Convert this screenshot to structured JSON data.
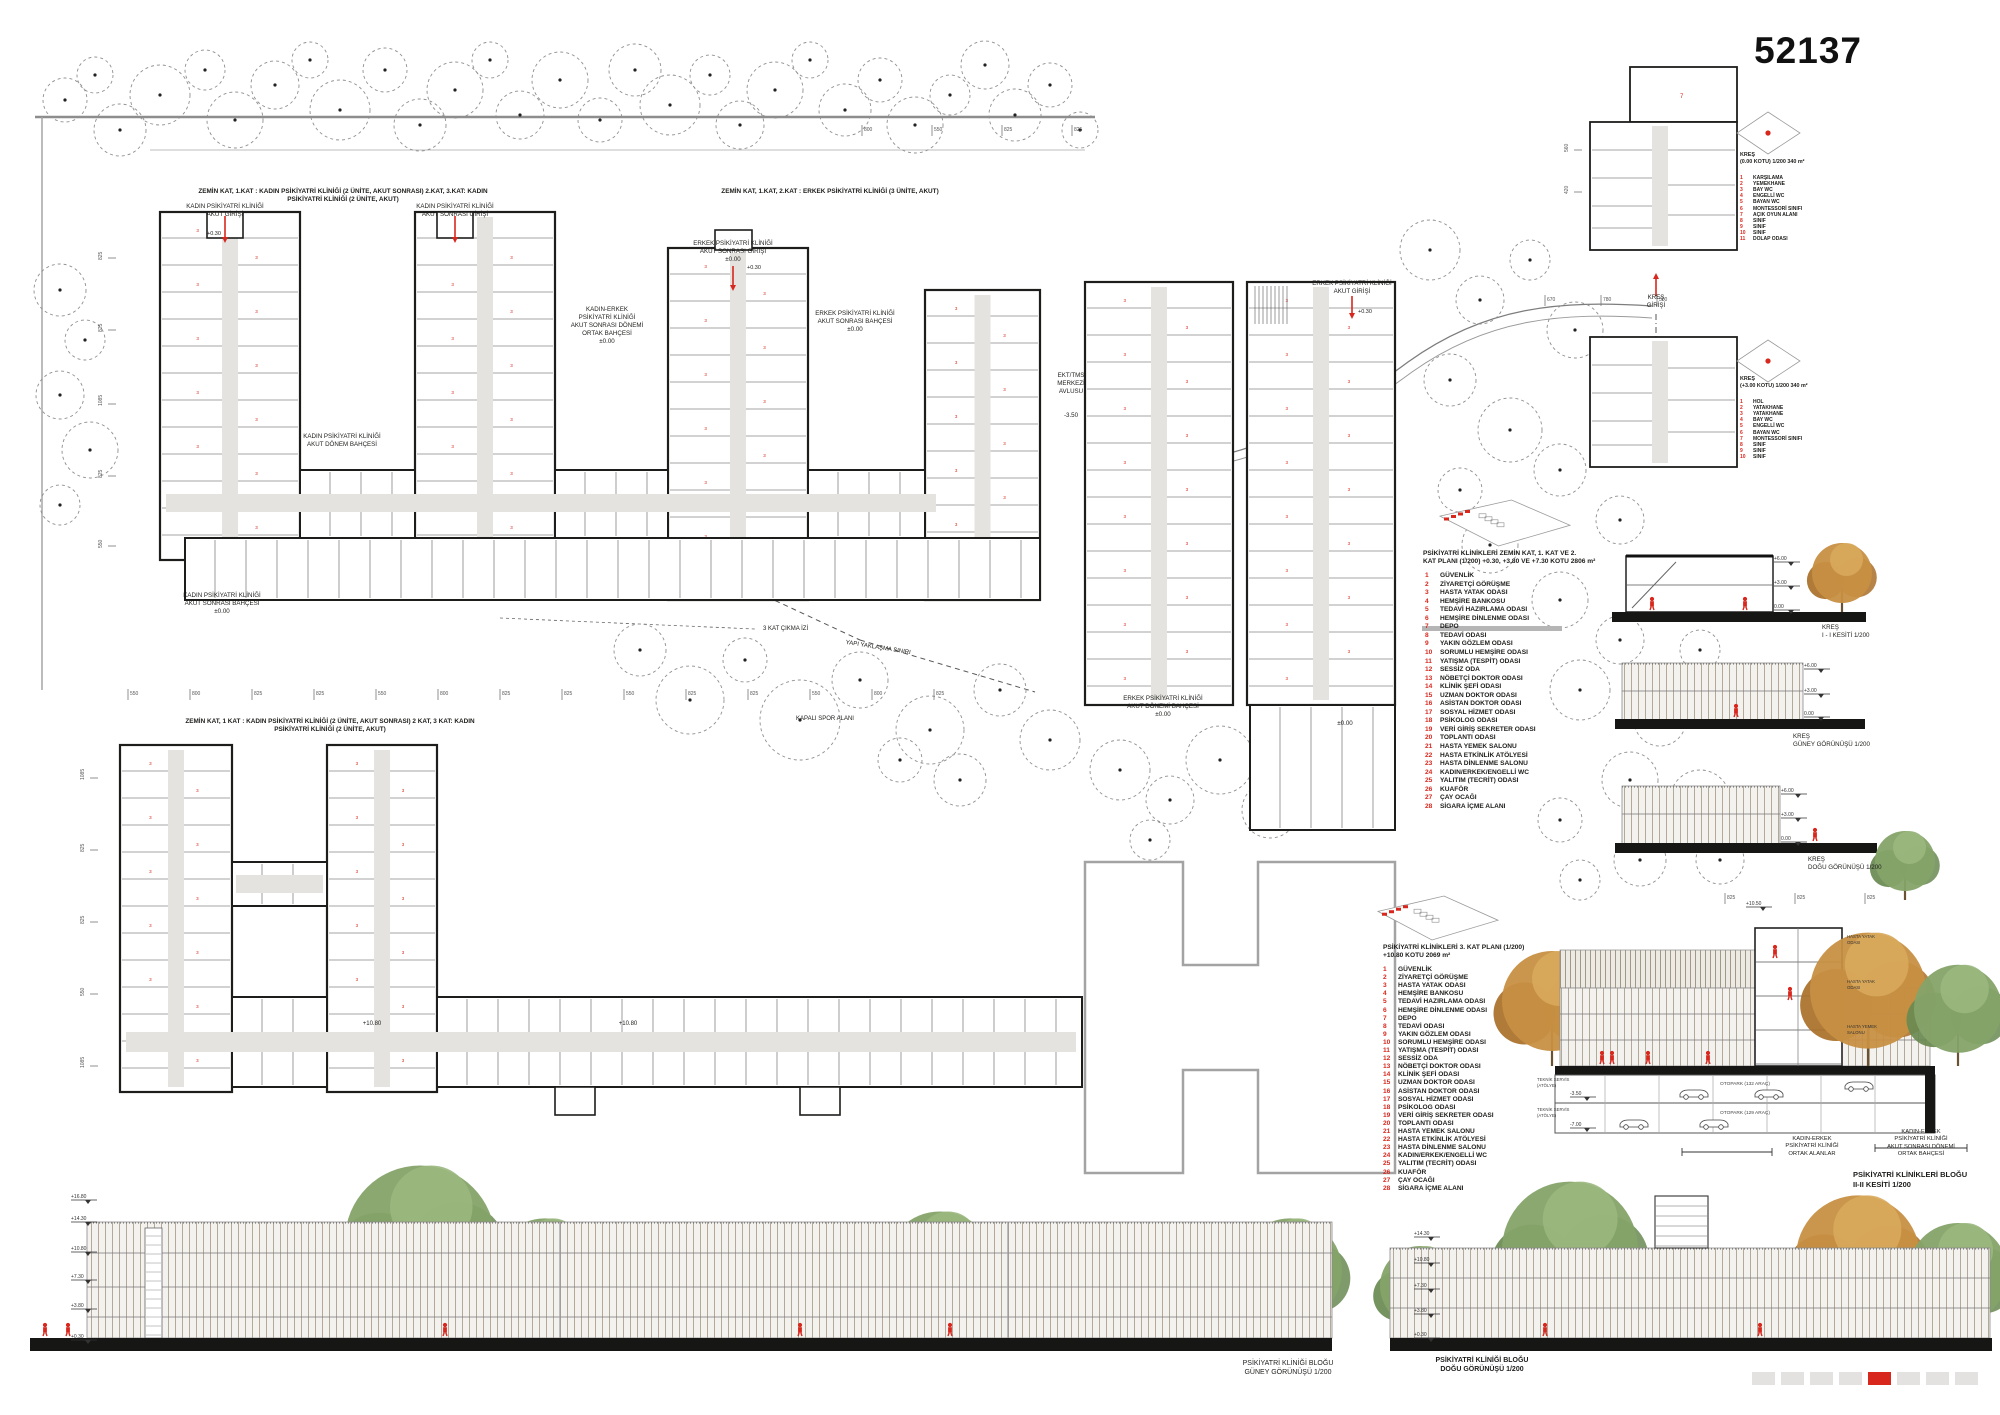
{
  "board": {
    "number": "52137"
  },
  "colors": {
    "accent": "#d8271d",
    "wall": "#1d1d1b",
    "corridor": "#e4e3e0",
    "gray_outline": "#a3a3a3",
    "ground": "#161614",
    "dim": "#555555",
    "tree_dash": "#8f8f8f",
    "green": "#85a369",
    "green_dark": "#698a51",
    "autumn": "#c78f42",
    "autumn_dark": "#a96f28",
    "facade": "#f4f2ee",
    "mullion": "#b2a998",
    "page_square": "#e3e2e0"
  },
  "annotations": [
    {
      "t": "ZEMİN KAT, 1.KAT : KADIN PSİKİYATRİ KLİNİĞİ (2 ÜNİTE, AKUT SONRASI) 2.KAT, 3.KAT: KADIN PSİKİYATRİ KLİNİĞİ (2 ÜNİTE, AKUT)",
      "x": 343,
      "y": 188,
      "size": 6.4,
      "bold": true
    },
    {
      "t": "ZEMİN KAT, 1.KAT, 2.KAT : ERKEK PSİKİYATRİ KLİNİĞİ (3 ÜNİTE, AKUT)",
      "x": 830,
      "y": 188,
      "size": 6.4,
      "bold": true
    },
    {
      "t": "ZEMİN KAT, 1 KAT : KADIN PSİKİYATRİ KLİNİĞİ (2 ÜNİTE, AKUT SONRASI) 2 KAT, 3 KAT: KADIN PSİKİYATRİ KLİNİĞİ (2 ÜNİTE, AKUT)",
      "x": 330,
      "y": 718,
      "size": 6.4,
      "bold": true
    },
    {
      "t": "KADIN PSİKİYATRİ KLİNİĞİ\nAKUT GİRİŞİ",
      "x": 225,
      "y": 203,
      "size": 6.2
    },
    {
      "t": "KADIN PSİKİYATRİ KLİNİĞİ\nAKUT SONRASI GİRİŞİ",
      "x": 455,
      "y": 203,
      "size": 6.2
    },
    {
      "t": "ERKEK PSİKİYATRİ KLİNİĞİ\nAKUT SONRASI GİRİŞİ\n±0.00",
      "x": 733,
      "y": 240,
      "size": 6.2
    },
    {
      "t": "KADIN-ERKEK\nPSİKİYATRİ KLİNİĞİ\nAKUT SONRASI DÖNEMİ\nORTAK BAHÇESİ\n±0.00",
      "x": 607,
      "y": 306,
      "size": 6.2
    },
    {
      "t": "ERKEK PSİKİYATRİ KLİNİĞİ\nAKUT SONRASI BAHÇESİ\n±0.00",
      "x": 855,
      "y": 310,
      "size": 6.2
    },
    {
      "t": "KADIN PSİKİYATRİ KLİNİĞİ\nAKUT  DÖNEM BAHÇESİ",
      "x": 342,
      "y": 433,
      "size": 6.2
    },
    {
      "t": "EKT/TMS\nMERKEZİ\nAVLUSU",
      "x": 1071,
      "y": 372,
      "size": 6.2
    },
    {
      "t": "-3.50",
      "x": 1071,
      "y": 412,
      "size": 6.2
    },
    {
      "t": "ERKEK PSİKİYATRİ KLİNİĞİ\nAKUT GİRİŞİ",
      "x": 1352,
      "y": 280,
      "size": 6.2
    },
    {
      "t": "KREŞ\nGİRİŞİ",
      "x": 1656,
      "y": 294,
      "size": 6.2
    },
    {
      "t": "KADIN PSİKİYATRİ KLİNİĞİ\nAKUT SONRASI BAHÇESİ\n±0.00",
      "x": 222,
      "y": 592,
      "size": 6.2
    },
    {
      "t": "ERKEK PSİKİYATRİ KLİNİĞİ\nAKUT DÖNEMİ BAHÇESİ\n±0.00",
      "x": 1163,
      "y": 695,
      "size": 6.2
    },
    {
      "t": "±0.00",
      "x": 1345,
      "y": 720,
      "size": 6.2
    },
    {
      "t": "3 KAT ÇIKMA İZİ",
      "x": 763,
      "y": 626,
      "size": 6,
      "align": "left"
    },
    {
      "t": "YAPI YAKLAŞMA SINIRI",
      "x": 878,
      "y": 645,
      "size": 6,
      "rot": 9
    },
    {
      "t": "KAPALI SPOR ALANI",
      "x": 825,
      "y": 716,
      "size": 6
    },
    {
      "t": "+10.80",
      "x": 372,
      "y": 1021,
      "size": 6
    },
    {
      "t": "+10.80",
      "x": 628,
      "y": 1021,
      "size": 6
    },
    {
      "t": "+0.30",
      "x": 207,
      "y": 231,
      "size": 5.5,
      "align": "left"
    },
    {
      "t": "+0.30",
      "x": 747,
      "y": 265,
      "size": 5.5,
      "align": "left"
    },
    {
      "t": "+0.30",
      "x": 1358,
      "y": 309,
      "size": 5.5,
      "align": "left"
    },
    {
      "t": "PSİKİYATRİ KLİNİKLERİ ZEMİN KAT, 1. KAT VE 2.\nKAT  PLANI (1/200) +0.30, +3.80 VE +7.30 KOTU  2806 m²",
      "x": 1423,
      "y": 550,
      "size": 6.6,
      "bold": true,
      "align": "left"
    },
    {
      "t": "PSİKİYATRİ KLİNİKLERİ 3. KAT  PLANI (1/200)\n+10.80 KOTU 2069 m²",
      "x": 1383,
      "y": 944,
      "size": 6.6,
      "bold": true,
      "align": "left"
    },
    {
      "t": "KREŞ\n(0.00 KOTU) 1/200  340 m²",
      "x": 1740,
      "y": 152,
      "size": 5.4,
      "bold": true,
      "align": "left"
    },
    {
      "t": "KREŞ\n(+3.00 KOTU) 1/200 340 m²",
      "x": 1740,
      "y": 376,
      "size": 5.4,
      "bold": true,
      "align": "left"
    },
    {
      "t": "KREŞ\nI - I KESİTİ 1/200",
      "x": 1822,
      "y": 624,
      "size": 6.2,
      "align": "left"
    },
    {
      "t": "KREŞ\nGÜNEY GÖRÜNÜŞÜ 1/200",
      "x": 1793,
      "y": 733,
      "size": 6.2,
      "align": "left"
    },
    {
      "t": "KREŞ\nDOĞU GÖRÜNÜŞÜ 1/200",
      "x": 1808,
      "y": 856,
      "size": 6.2,
      "align": "left"
    },
    {
      "t": "PSİKİYATRİ KLİNİKLERİ BLOĞU\nII-II KESİTİ 1/200",
      "x": 1853,
      "y": 1170,
      "size": 7.5,
      "bold": true,
      "align": "left"
    },
    {
      "t": "KADIN-ERKEK\nPSİKİYATRİ KLİNİĞİ\nORTAK ALANLAR",
      "x": 1812,
      "y": 1136,
      "size": 5.8
    },
    {
      "t": "KADIN-ERKEK\nPSİKİYATRİ KLİNİĞİ\nAKUT SONRASI DÖNEMİ\nORTAK BAHÇESİ",
      "x": 1921,
      "y": 1129,
      "size": 5.8
    },
    {
      "t": "OTOPARK (132 ARAÇ)",
      "x": 1745,
      "y": 1082,
      "size": 4.8,
      "color": "#444444"
    },
    {
      "t": "OTOPARK (129 ARAÇ)",
      "x": 1745,
      "y": 1111,
      "size": 4.8,
      "color": "#444444"
    },
    {
      "t": "TEKNİK SERVİS\n(ATÖLYE)",
      "x": 1537,
      "y": 1077,
      "size": 4.3,
      "align": "left",
      "color": "#444444"
    },
    {
      "t": "TEKNİK SERVİS\n(ATÖLYE)",
      "x": 1537,
      "y": 1107,
      "size": 4.3,
      "align": "left",
      "color": "#444444"
    },
    {
      "t": "HASTA YATAK\nODASI",
      "x": 1847,
      "y": 934,
      "size": 4.3,
      "align": "left",
      "color": "#333333"
    },
    {
      "t": "HASTA YATAK\nODASI",
      "x": 1847,
      "y": 979,
      "size": 4.3,
      "align": "left",
      "color": "#333333"
    },
    {
      "t": "HASTA YEMEK\nSALONU",
      "x": 1847,
      "y": 1024,
      "size": 4.3,
      "align": "left",
      "color": "#333333"
    },
    {
      "t": "PSİKİYATRİ KLİNİĞİ BLOĞU\nGÜNEY GÖRÜNÜŞÜ 1/200",
      "x": 1288,
      "y": 1360,
      "size": 7
    },
    {
      "t": "PSİKİYATRİ KLİNİĞİ BLOĞU\nDOĞU GÖRÜNÜŞÜ 1/200",
      "x": 1482,
      "y": 1357,
      "size": 7,
      "bold": true
    }
  ],
  "legends": [
    {
      "id": "kres-ground",
      "x_num": 1740,
      "x_text": 1753,
      "y0": 175,
      "step": 6.1,
      "size": 5,
      "items": [
        "KARŞILAMA",
        "YEMEKHANE",
        "BAY WC",
        "ENGELLİ WC",
        "BAYAN WC",
        "MONTESSORİ SINIFI",
        "AÇIK OYUN ALANI",
        "SINIF",
        "SINIF",
        "SINIF",
        "DOLAP ODASI"
      ]
    },
    {
      "id": "kres-upper",
      "x_num": 1740,
      "x_text": 1753,
      "y0": 399,
      "step": 6.1,
      "size": 5,
      "items": [
        "HOL",
        "YATAKHANE",
        "YATAKHANE",
        "BAY WC",
        "ENGELLİ WC",
        "BAYAN WC",
        "MONTESSORİ SINIFI",
        "SINIF",
        "SINIF",
        "SINIF"
      ]
    },
    {
      "id": "clinic-levels-012",
      "x_num": 1425,
      "x_text": 1440,
      "y0": 572,
      "step": 8.55,
      "size": 6.6,
      "items": [
        "GÜVENLİK",
        "ZİYARETÇİ GÖRÜŞME",
        "HASTA YATAK ODASI",
        "HEMŞİRE BANKOSU",
        "TEDAVİ HAZIRLAMA ODASI",
        "HEMŞİRE DİNLENME ODASI",
        "DEPO",
        "TEDAVİ ODASI",
        "YAKIN GÖZLEM ODASI",
        "SORUMLU HEMŞİRE ODASI",
        "YATIŞMA (TESPİT) ODASI",
        "SESSİZ ODA",
        "NÖBETÇİ DOKTOR ODASI",
        "KLİNİK ŞEFİ ODASI",
        "UZMAN DOKTOR ODASI",
        "ASİSTAN DOKTOR ODASI",
        "SOSYAL HİZMET ODASI",
        "PSİKOLOG ODASI",
        "VERİ GİRİŞ SEKRETER ODASI",
        "TOPLANTI ODASI",
        "HASTA YEMEK SALONU",
        "HASTA ETKİNLİK ATÖLYESİ",
        "HASTA DİNLENME SALONU",
        "KADIN/ERKEK/ENGELLİ WC",
        "YALITIM (TECRİT) ODASI",
        "KUAFÖR",
        "ÇAY OCAĞI",
        "SİGARA İÇME ALANI"
      ]
    },
    {
      "id": "clinic-level-3",
      "x_num": 1383,
      "x_text": 1398,
      "y0": 966,
      "step": 8.1,
      "size": 6.6,
      "items": [
        "GÜVENLİK",
        "ZİYARETÇİ GÖRÜŞME",
        "HASTA YATAK ODASI",
        "HEMŞİRE BANKOSU",
        "TEDAVİ HAZIRLAMA ODASI",
        "HEMŞİRE DİNLENME ODASI",
        "DEPO",
        "TEDAVİ ODASI",
        "YAKIN GÖZLEM ODASI",
        "SORUMLU HEMŞİRE ODASI",
        "YATIŞMA (TESPİT) ODASI",
        "SESSİZ ODA",
        "NÖBETÇİ DOKTOR ODASI",
        "KLİNİK ŞEFİ ODASI",
        "UZMAN DOKTOR ODASI",
        "ASİSTAN DOKTOR ODASI",
        "SOSYAL HİZMET ODASI",
        "PSİKOLOG ODASI",
        "VERİ GİRİŞ SEKRETER ODASI",
        "TOPLANTI ODASI",
        "HASTA YEMEK SALONU",
        "HASTA ETKİNLİK ATÖLYESİ",
        "HASTA DİNLENME SALONU",
        "KADIN/ERKEK/ENGELLİ WC",
        "YALITIM (TECRİT) ODASI",
        "KUAFÖR",
        "ÇAY OCAĞI",
        "SİGARA İÇME ALANI"
      ]
    }
  ],
  "dim_rows": [
    {
      "x0": 128,
      "y": 686,
      "step": 62,
      "values": [
        "550",
        "800",
        "825",
        "825",
        "550",
        "800",
        "825",
        "825",
        "550",
        "825",
        "825",
        "550",
        "800",
        "825"
      ]
    },
    {
      "x0": 862,
      "y": 122,
      "step": 70,
      "values": [
        "800",
        "550",
        "825",
        "825"
      ]
    },
    {
      "x0": 1725,
      "y": 890,
      "step": 70,
      "values": [
        "825",
        "825",
        "825"
      ]
    },
    {
      "x0": 1545,
      "y": 292,
      "step": 56,
      "values": [
        "670",
        "780",
        "500"
      ]
    }
  ],
  "dim_vertical": [
    {
      "x": 102,
      "y": 258,
      "t": "825"
    },
    {
      "x": 102,
      "y": 330,
      "t": "825"
    },
    {
      "x": 102,
      "y": 404,
      "t": "1085"
    },
    {
      "x": 102,
      "y": 476,
      "t": "825"
    },
    {
      "x": 102,
      "y": 546,
      "t": "550"
    },
    {
      "x": 84,
      "y": 778,
      "t": "1085"
    },
    {
      "x": 84,
      "y": 850,
      "t": "825"
    },
    {
      "x": 84,
      "y": 922,
      "t": "825"
    },
    {
      "x": 84,
      "y": 994,
      "t": "550"
    },
    {
      "x": 84,
      "y": 1066,
      "t": "1085"
    },
    {
      "x": 1568,
      "y": 150,
      "t": "560"
    },
    {
      "x": 1568,
      "y": 192,
      "t": "420"
    }
  ],
  "levels": [
    {
      "x": 95,
      "y": 1194,
      "t": "+16.80"
    },
    {
      "x": 95,
      "y": 1216,
      "t": "+14.30"
    },
    {
      "x": 95,
      "y": 1246,
      "t": "+10.80"
    },
    {
      "x": 95,
      "y": 1274,
      "t": "+7.30"
    },
    {
      "x": 95,
      "y": 1303,
      "t": "+3.80"
    },
    {
      "x": 95,
      "y": 1334,
      "t": "+0.30"
    },
    {
      "x": 1438,
      "y": 1231,
      "t": "+14.30"
    },
    {
      "x": 1438,
      "y": 1257,
      "t": "+10.80"
    },
    {
      "x": 1438,
      "y": 1283,
      "t": "+7.30"
    },
    {
      "x": 1438,
      "y": 1308,
      "t": "+3.80"
    },
    {
      "x": 1438,
      "y": 1332,
      "t": "+0.30"
    },
    {
      "x": 1798,
      "y": 556,
      "t": "+6.00"
    },
    {
      "x": 1798,
      "y": 580,
      "t": "+3.00"
    },
    {
      "x": 1798,
      "y": 604,
      "t": "0.00"
    },
    {
      "x": 1828,
      "y": 663,
      "t": "+6.00"
    },
    {
      "x": 1828,
      "y": 688,
      "t": "+3.00"
    },
    {
      "x": 1828,
      "y": 711,
      "t": "0.00"
    },
    {
      "x": 1805,
      "y": 788,
      "t": "+6.00"
    },
    {
      "x": 1805,
      "y": 812,
      "t": "+3.00"
    },
    {
      "x": 1805,
      "y": 836,
      "t": "0.00"
    },
    {
      "x": 1594,
      "y": 1091,
      "t": "-3.50"
    },
    {
      "x": 1594,
      "y": 1122,
      "t": "-7.00"
    },
    {
      "x": 1770,
      "y": 901,
      "t": "+10.50"
    }
  ],
  "plans": {
    "room_number": "3"
  },
  "pagination": {
    "count": 8,
    "active": 4
  }
}
